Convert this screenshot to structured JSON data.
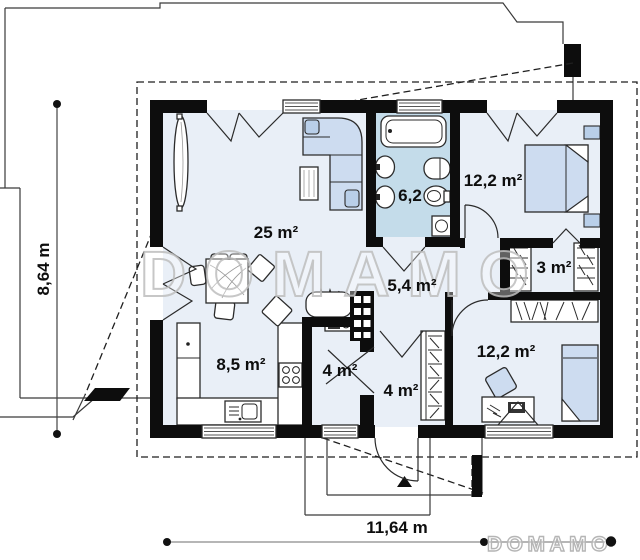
{
  "title": "single-storey house floor plan",
  "watermark": {
    "text": "DOMAMO"
  },
  "logo": {
    "text": "DOMAMO"
  },
  "dimensions": {
    "height_label": "8,64 m",
    "width_label": "11,64 m"
  },
  "rooms": [
    {
      "id": "living-room",
      "label": "25 m²"
    },
    {
      "id": "bathroom",
      "label": "6,2"
    },
    {
      "id": "bedroom-1",
      "label": "12,2 m²"
    },
    {
      "id": "wardrobe",
      "label": "3 m²"
    },
    {
      "id": "hall",
      "label": "5,4 m²"
    },
    {
      "id": "kitchen",
      "label": "8,5 m²"
    },
    {
      "id": "storage-wc",
      "label": "4 m²"
    },
    {
      "id": "vestibule",
      "label": "4 m²"
    },
    {
      "id": "bedroom-2",
      "label": "12,2 m²"
    }
  ],
  "colors": {
    "wall": "#0d0d0d",
    "room_floor": "#e9eff7",
    "bathroom_floor": "#c4dcea",
    "furniture_blue": "#cddcf0",
    "watermark_gray": "#c6c6c6",
    "dimension_line": "#444444"
  }
}
